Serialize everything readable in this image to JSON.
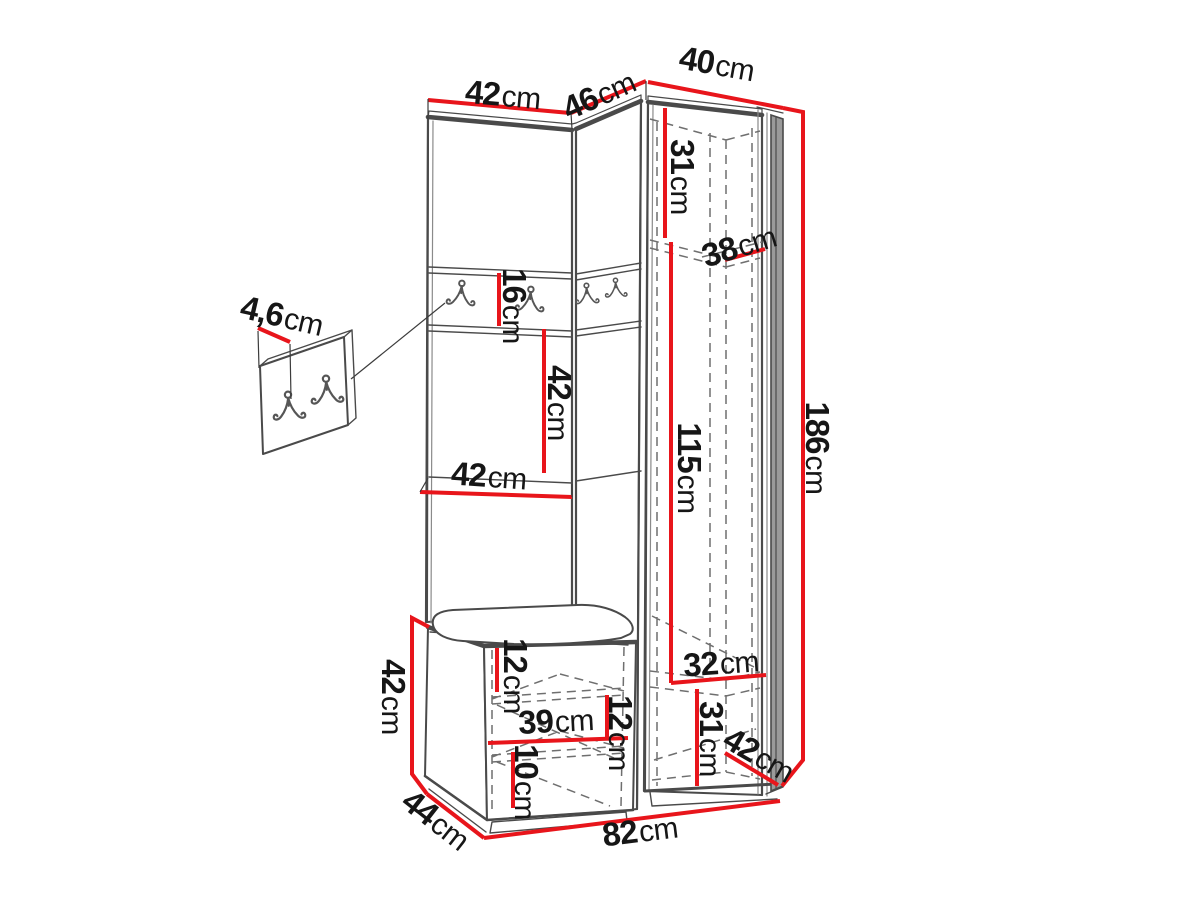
{
  "canvas": {
    "width": 1200,
    "height": 900
  },
  "colors": {
    "accent_red": "#e8151b",
    "line": "#4a4a4a",
    "line_soft": "#8a8a8a",
    "dash": "#6f6f6f",
    "text": "#161616",
    "door_fill": "#9a9a9a",
    "background": "#ffffff"
  },
  "icons": {
    "coat_hook": "double-coat-hook"
  },
  "dimensions": {
    "top_width_left": {
      "value": "42",
      "unit": "cm"
    },
    "top_width_middle": {
      "value": "46",
      "unit": "cm"
    },
    "top_width_right": {
      "value": "40",
      "unit": "cm"
    },
    "upper_shelf_height": {
      "value": "31",
      "unit": "cm"
    },
    "upper_shelf_depth": {
      "value": "38",
      "unit": "cm"
    },
    "hook_strip_height": {
      "value": "16",
      "unit": "cm"
    },
    "panel_mid_height": {
      "value": "42",
      "unit": "cm"
    },
    "panel_width": {
      "value": "42",
      "unit": "cm"
    },
    "hanging_height": {
      "value": "115",
      "unit": "cm"
    },
    "total_height": {
      "value": "186",
      "unit": "cm"
    },
    "bench_height": {
      "value": "42",
      "unit": "cm"
    },
    "bench_top_gap": {
      "value": "12",
      "unit": "cm"
    },
    "bench_inner_width": {
      "value": "39",
      "unit": "cm"
    },
    "bench_inner_gap": {
      "value": "12",
      "unit": "cm"
    },
    "bench_bottom_gap": {
      "value": "10",
      "unit": "cm"
    },
    "lower_shelf_width": {
      "value": "32",
      "unit": "cm"
    },
    "lower_shelf_height": {
      "value": "31",
      "unit": "cm"
    },
    "lower_shelf_depth": {
      "value": "42",
      "unit": "cm"
    },
    "total_width": {
      "value": "82",
      "unit": "cm"
    },
    "bench_depth": {
      "value": "44",
      "unit": "cm"
    },
    "hook_panel_thickness": {
      "value": "4,6",
      "unit": "cm"
    }
  }
}
